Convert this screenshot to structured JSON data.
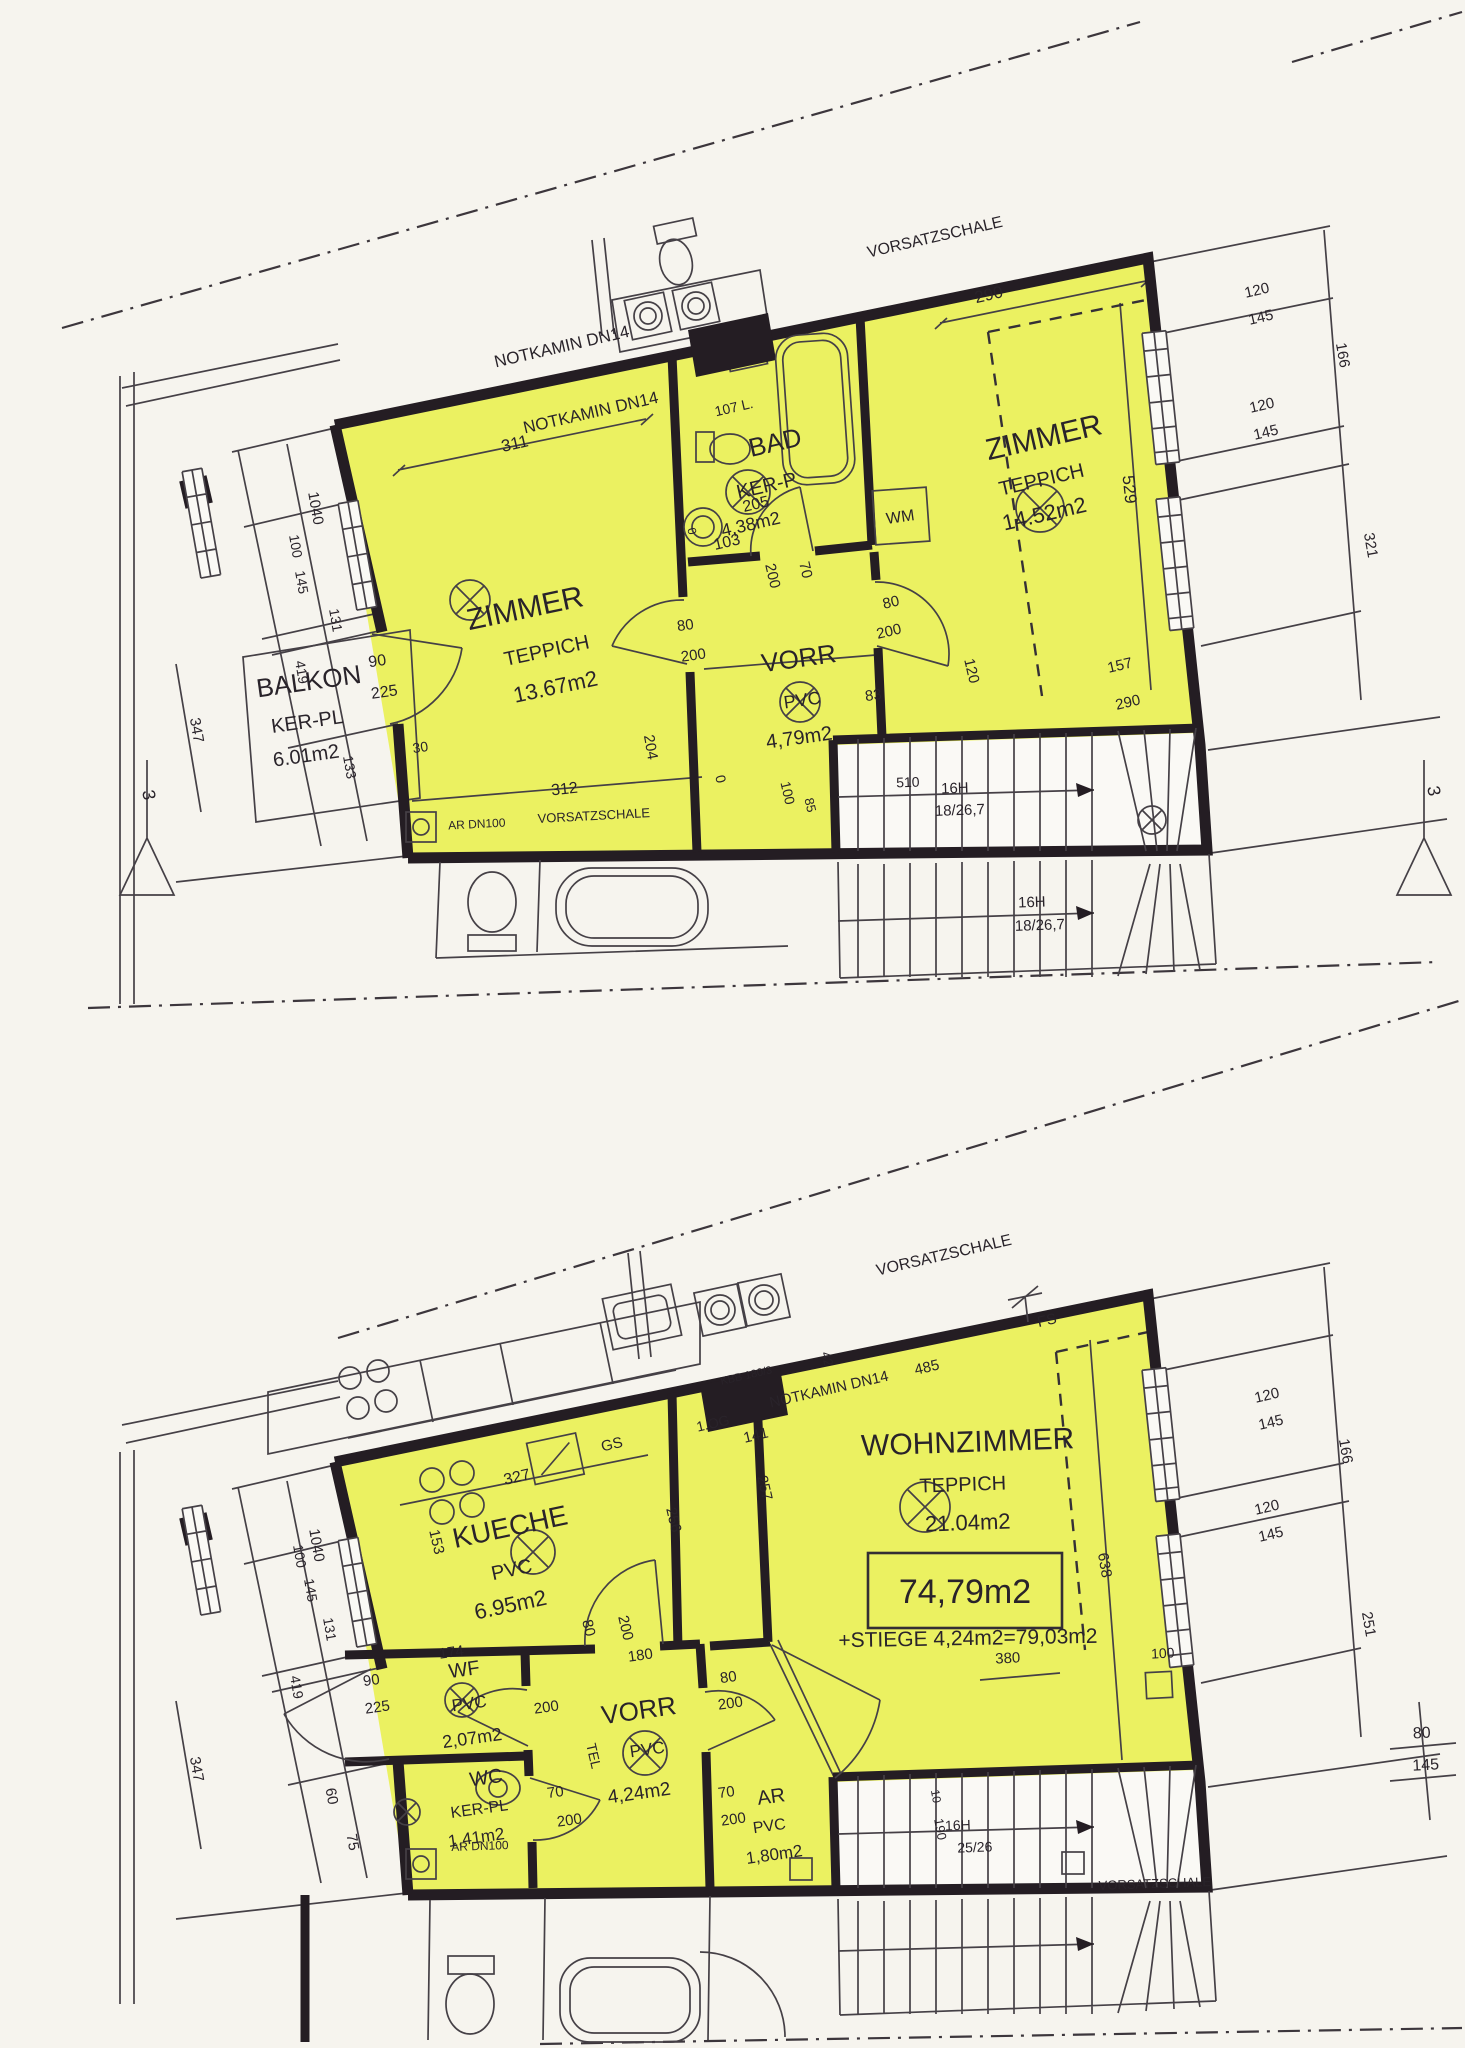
{
  "page": {
    "type": "scanned architectural floor plan, two storeys of a maisonette flat, rooms highlighted yellow"
  },
  "colors": {
    "room_fill": "#ebf161",
    "wall": "#241d23",
    "line": "#454046",
    "paper": "#f6f4ee"
  },
  "labels": {
    "notkamin": "NOTKAMIN DN14",
    "vorsatzschale": "VORSATZSCHALE",
    "ar_dn100": "AR DN100",
    "wm": "WM",
    "gs": "GS",
    "tel": "TEL",
    "fs": "FS",
    "boiler": "107 L.",
    "og": "1.OG",
    "kbb": "KBB 180/3",
    "section": "3",
    "stair_16h": "16H",
    "stair_ratio": "18/26,7",
    "stair_ratio2": "25/26",
    "total_area": "74,79m2",
    "stiege_note": "+STIEGE 4,24m2=79,03m2"
  },
  "rooms": {
    "zimmer1": {
      "name": "ZIMMER",
      "floor": "TEPPICH",
      "area": "13.67m2"
    },
    "bad": {
      "name": "BAD",
      "floor": "KER-P",
      "area": "4,38m2"
    },
    "vorr1": {
      "name": "VORR",
      "floor": "PVC",
      "area": "4,79m2"
    },
    "zimmer2": {
      "name": "ZIMMER",
      "floor": "TEPPICH",
      "area": "14.52m2"
    },
    "balkon": {
      "name": "BALKON",
      "floor": "KER-PL",
      "area": "6.01m2"
    },
    "kueche": {
      "name": "KUECHE",
      "floor": "PVC",
      "area": "6.95m2"
    },
    "wohnzimmer": {
      "name": "WOHNZIMMER",
      "floor": "TEPPICH",
      "area": "21.04m2"
    },
    "wf": {
      "name": "WF",
      "floor": "PVC",
      "area": "2,07m2"
    },
    "wc": {
      "name": "WC",
      "floor": "KER-PL",
      "area": "1,41m2"
    },
    "vorr2": {
      "name": "VORR",
      "floor": "PVC",
      "area": "4,24m2"
    },
    "ar": {
      "name": "AR",
      "floor": "PVC",
      "area": "1,80m2"
    }
  },
  "dims": {
    "v0": "0",
    "v10": "10",
    "v30": "30",
    "v42": "42",
    "v60": "60",
    "v70": "70",
    "v75": "75",
    "v80": "80",
    "v83": "83",
    "v85": "85",
    "v90": "90",
    "v100": "100",
    "v103": "103",
    "v120": "120",
    "v131": "131",
    "v133": "133",
    "v141": "141",
    "v145": "145",
    "v153": "153",
    "v157": "157",
    "v166": "166",
    "v174": "174",
    "v180": "180",
    "v190": "190",
    "v200": "200",
    "v204": "204",
    "v205": "205",
    "v225": "225",
    "v251": "251",
    "v256": "256",
    "v257": "257",
    "v290": "290",
    "v311": "311",
    "v312": "312",
    "v321": "321",
    "v327": "327",
    "v347": "347",
    "v380": "380",
    "v419": "419",
    "v485": "485",
    "v510": "510",
    "v529": "529",
    "v638": "638",
    "v1040": "1040"
  }
}
